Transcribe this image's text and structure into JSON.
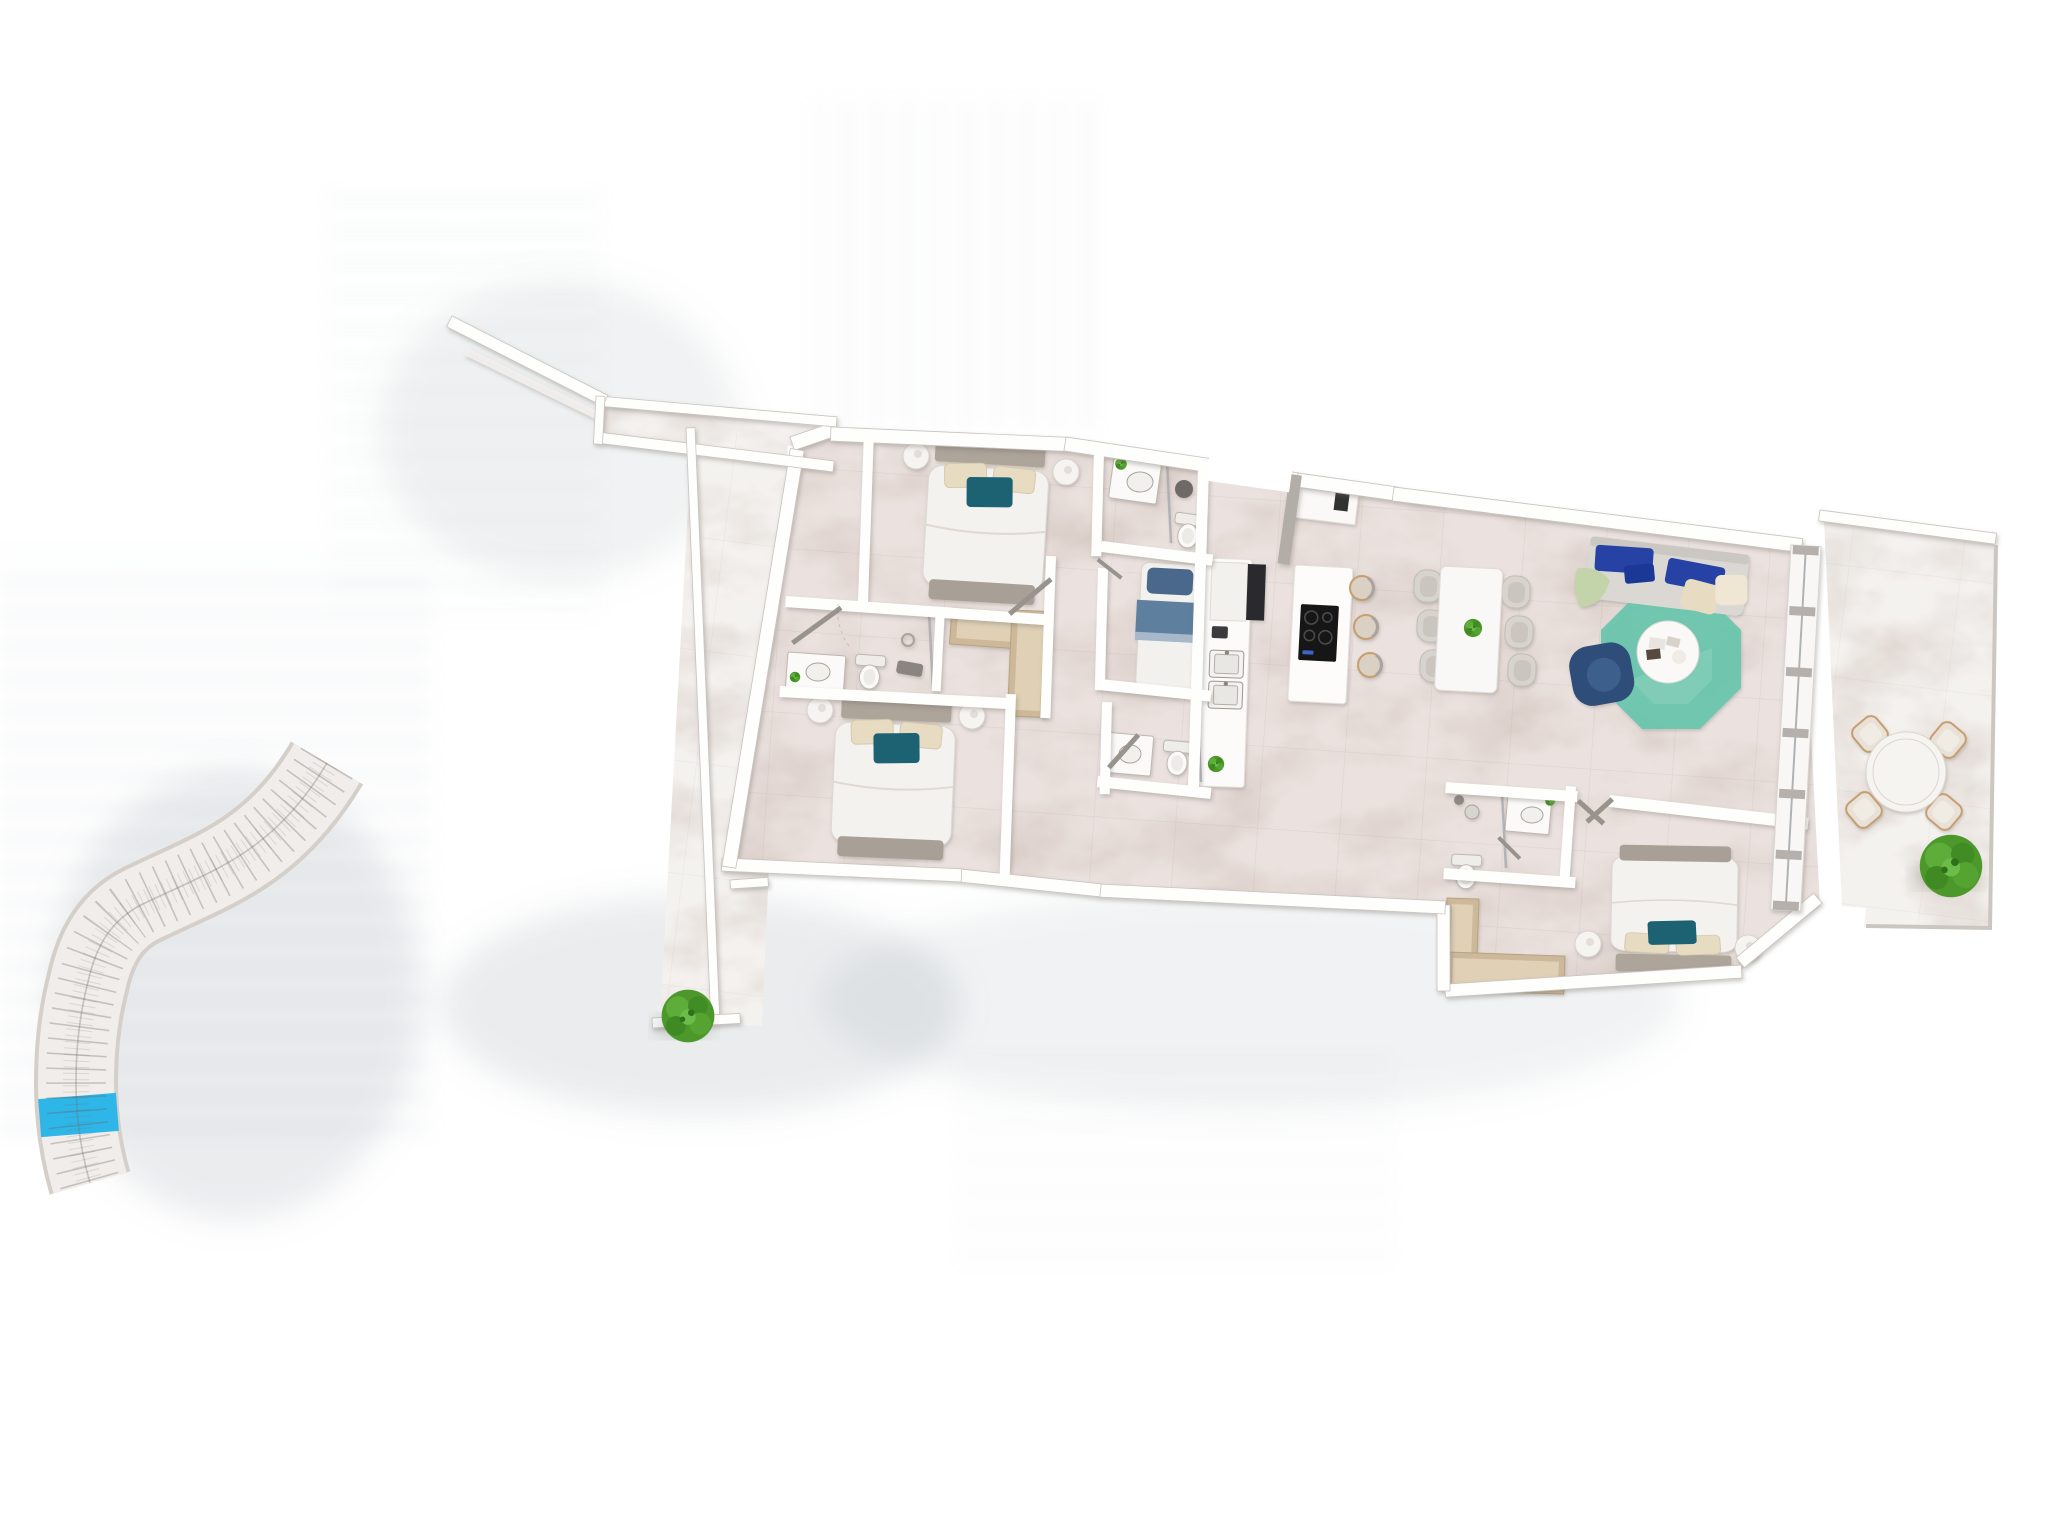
{
  "scene": {
    "kind": "3d-rendered-apartment-floor-plan",
    "background": "#ffffff"
  },
  "colors": {
    "background": "#ffffff",
    "floor_interior": "#EBE2DF",
    "floor_terrace": "#F4F2EF",
    "wall": "#FEFEFD",
    "wall_edge": "#C9C3BE",
    "glass": "#AEB2B5",
    "headboard": "#ADA49A",
    "bench": "#A8A096",
    "duvet": "#F4F2EF",
    "pillow_beige": "#E7DBC2",
    "pillow_teal": "#1D6272",
    "blanket_blue": "#5E7F9E",
    "blanket_blue_dark": "#48688C",
    "sofa": "#DBD8D4",
    "sofa_blue": "#2543A4",
    "throw_green": "#C3D3AA",
    "rug_teal": "#6AC6AD",
    "armchair": "#2F4E78",
    "coffee_table": "#FAF9F7",
    "chair": "#D7D3CE",
    "stool_rim": "#C79E6F",
    "wood": "#CDB899",
    "wood_light": "#DFD0B6",
    "hob": "#161616",
    "appliance_dark": "#2B2B2E",
    "fixture_stroke": "#BDB7B1",
    "tree": "#4C982B",
    "siteplan_band": "#F0EDEA",
    "siteplan_edge": "#D5CFC9",
    "siteplan_line": "#6E645C",
    "siteplan_highlight": "#2FB6E9",
    "shadow_tint": "#9FB0BC"
  },
  "apartment": {
    "rooms": [
      {
        "id": "bedroom-1",
        "furniture": [
          "double-bed",
          "nightstand",
          "nightstand",
          "foot-bench",
          "wardrobe"
        ]
      },
      {
        "id": "bedroom-2",
        "furniture": [
          "double-bed",
          "nightstand",
          "nightstand",
          "foot-bench"
        ]
      },
      {
        "id": "bedroom-3",
        "furniture": [
          "single-bed"
        ]
      },
      {
        "id": "master-bedroom",
        "furniture": [
          "double-bed",
          "nightstand",
          "nightstand",
          "wardrobe"
        ]
      },
      {
        "id": "bathroom-1",
        "furniture": [
          "vanity-sink",
          "toilet",
          "shower",
          "plant"
        ]
      },
      {
        "id": "bathroom-2",
        "furniture": [
          "vanity-sink",
          "toilet",
          "shower",
          "plant"
        ]
      },
      {
        "id": "bathroom-3",
        "furniture": [
          "vanity-sink",
          "toilet",
          "shower"
        ]
      },
      {
        "id": "master-ensuite",
        "furniture": [
          "vanity-sink",
          "toilet",
          "shower",
          "plant"
        ]
      },
      {
        "id": "kitchen",
        "furniture": [
          "island-with-hob",
          "bar-stool",
          "bar-stool",
          "bar-stool",
          "counter-with-sinks",
          "fridge",
          "plant"
        ]
      },
      {
        "id": "dining-area",
        "furniture": [
          "dining-table",
          "dining-chair",
          "dining-chair",
          "dining-chair",
          "dining-chair",
          "dining-chair",
          "dining-chair",
          "plant"
        ]
      },
      {
        "id": "living-room",
        "furniture": [
          "sofa",
          "rug",
          "coffee-table",
          "armchair"
        ]
      },
      {
        "id": "entry-hall",
        "furniture": [
          "entry-door"
        ]
      },
      {
        "id": "terrace-left",
        "furniture": [
          "bush"
        ]
      },
      {
        "id": "terrace-right",
        "furniture": [
          "round-table",
          "outdoor-chair",
          "outdoor-chair",
          "outdoor-chair",
          "outdoor-chair",
          "bush"
        ]
      }
    ]
  },
  "site_plan": {
    "kind": "curved-building-masterplan-strip",
    "highlighted_unit_color": "#2FB6E9"
  }
}
